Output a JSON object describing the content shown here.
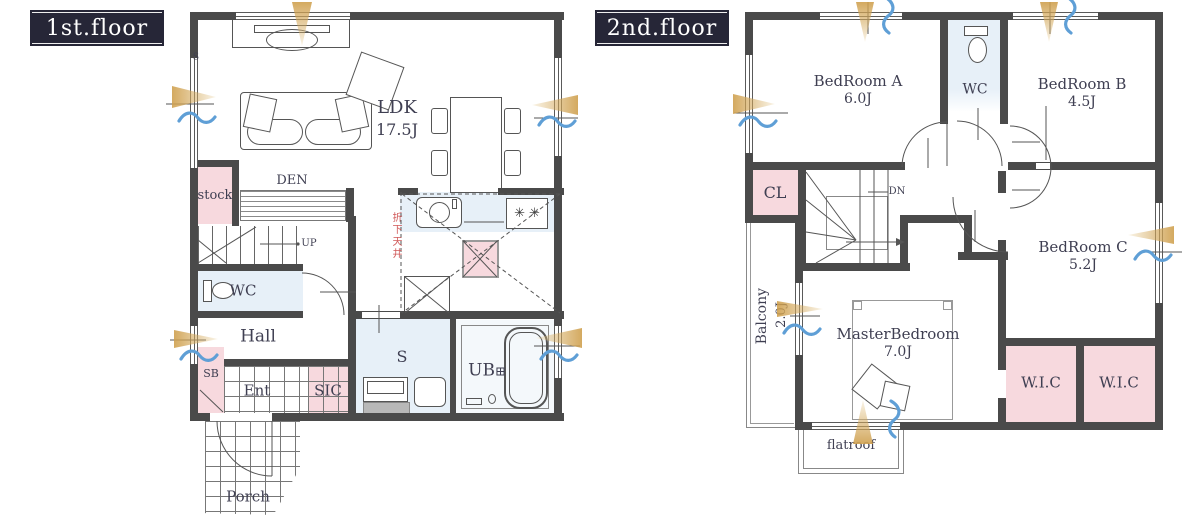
{
  "floor1": {
    "title": "1st.floor",
    "ldk": {
      "name": "LDK",
      "size": "17.5J"
    },
    "den": "DEN",
    "stock": "stock",
    "up": "UP",
    "wc": "WC",
    "hall": "Hall",
    "sb": "SB",
    "ent": "Ent",
    "sic": "SIC",
    "storage": "S",
    "bath": "UB",
    "bath_icon": "⊞",
    "porch": "Porch",
    "dropped_ceiling": "折下天井",
    "shutter": "S"
  },
  "floor2": {
    "title": "2nd.floor",
    "bedroom_a": {
      "name": "BedRoom A",
      "size": "6.0J"
    },
    "wc": "WC",
    "bedroom_b": {
      "name": "BedRoom B",
      "size": "4.5J"
    },
    "cl": "CL",
    "dn": "DN",
    "bedroom_c": {
      "name": "BedRoom C",
      "size": "5.2J"
    },
    "balcony": {
      "name": "Balcony",
      "size": "2.0J"
    },
    "master": {
      "name": "MasterBedroom",
      "size": "7.0J"
    },
    "wic_left": "W.I.C",
    "wic_right": "W.I.C",
    "flatroof": "flatroof"
  },
  "icons": {
    "burner": "✳"
  },
  "colors": {
    "wall": "#4a4a4a",
    "room_pink": "#f7d9de",
    "room_blue": "#e7f0f8",
    "title_bg": "#262637",
    "sunlight": "#cfa04e",
    "wind": "#5f9fd6",
    "red_note": "#d05858"
  }
}
